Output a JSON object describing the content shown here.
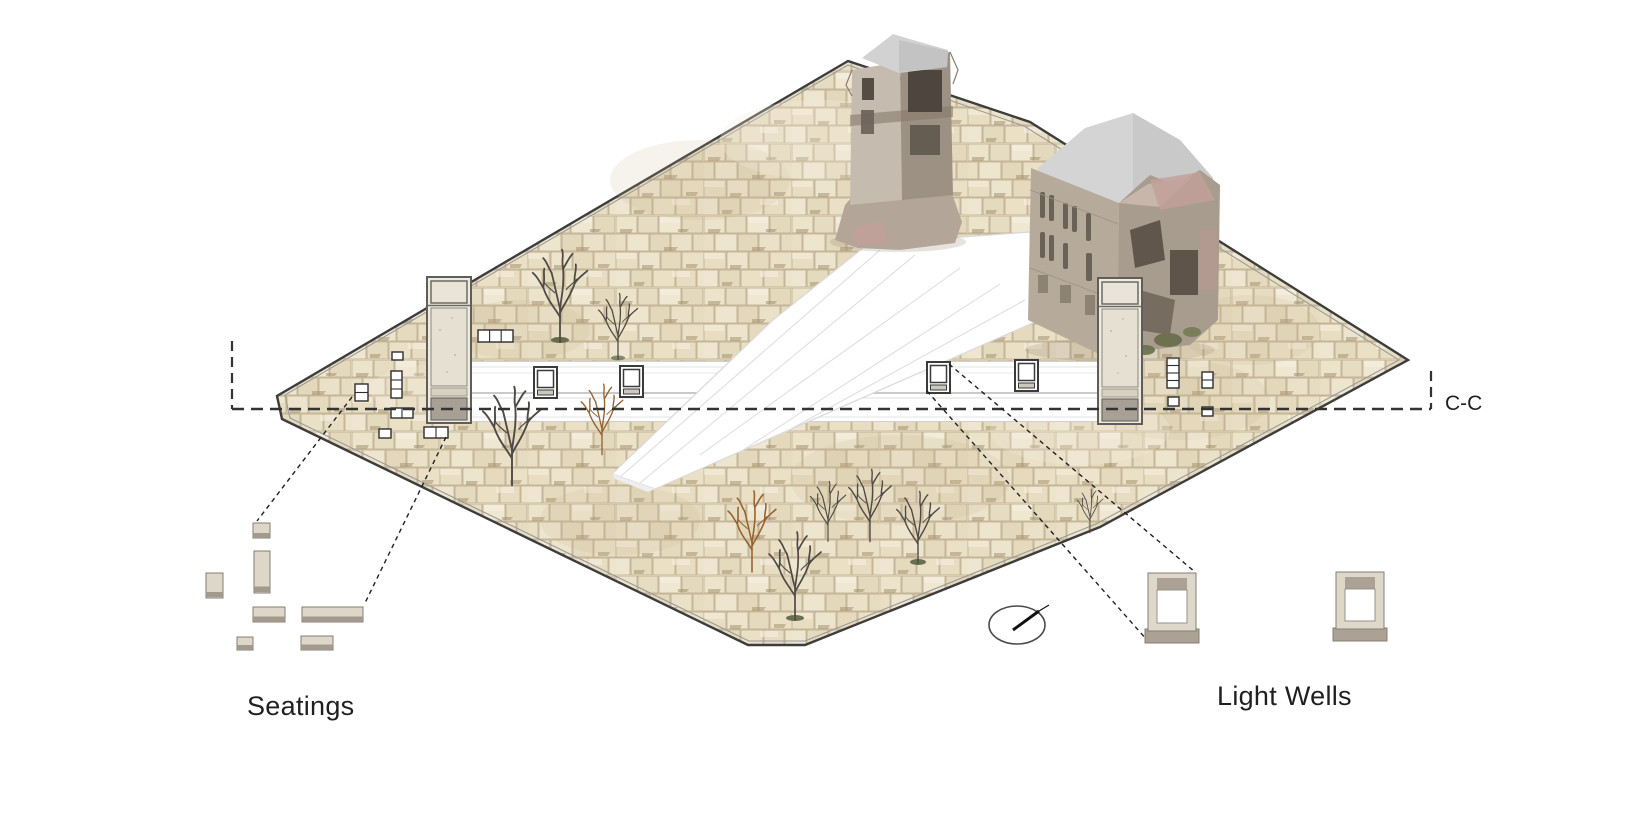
{
  "labels": {
    "seatings": "Seatings",
    "light_wells": "Light Wells",
    "section": "C-C"
  },
  "icons": {
    "north_arrow": "north-arrow"
  },
  "colors": {
    "bg": "#ffffff",
    "text": "#1f1f1f",
    "terrain": "#eae0c7",
    "joint": "#b3a282",
    "outline": "#3d3d3d",
    "tower-body": "#e6e0d2",
    "tower-base": "#a8a094",
    "seat": "#ddd6c9",
    "seatband": "#a29a8c",
    "wellframe": "#ded8cb",
    "wellgray": "#aba295",
    "roof": "#d2d2d2",
    "ruin-light": "#c6bbaf",
    "ruin-mid": "#a89c8f",
    "ruin-dark": "#554d44",
    "tree": "#4f4a45",
    "tree-dry": "#96622f",
    "dash": "#333333"
  }
}
